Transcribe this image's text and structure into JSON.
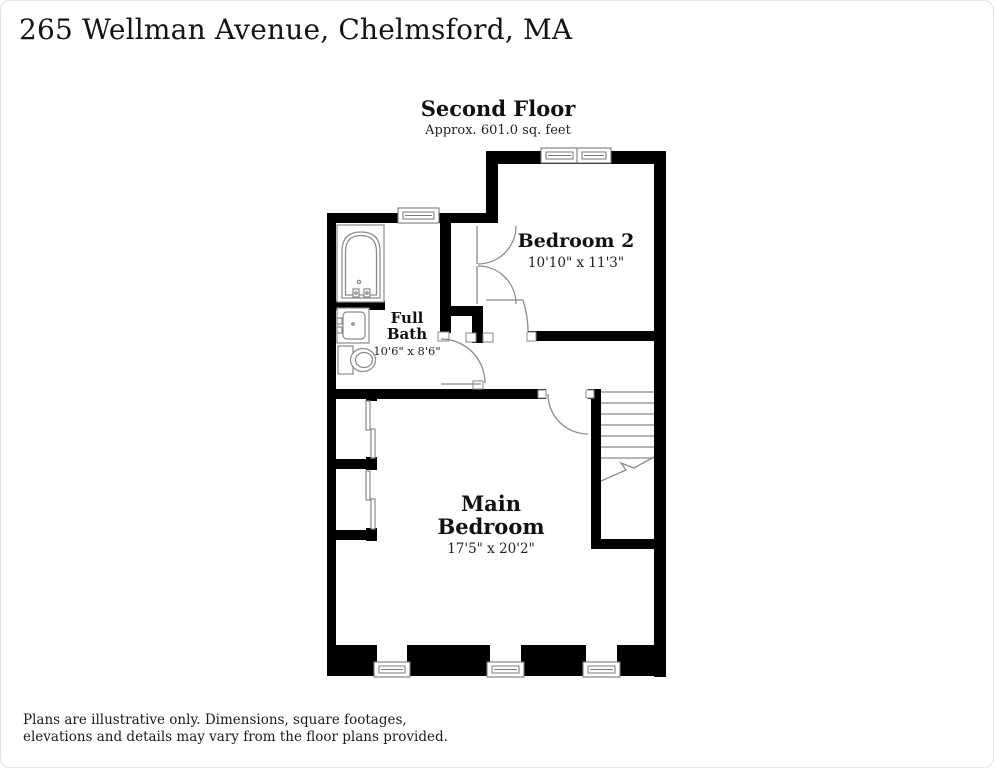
{
  "header": {
    "title": "265 Wellman Avenue, Chelmsford, MA"
  },
  "plan": {
    "heading": "Second Floor",
    "subheading": "Approx. 601.0 sq. feet"
  },
  "rooms": {
    "bedroom2": {
      "name": "Bedroom 2",
      "dims": "10'10\" x 11'3\""
    },
    "bath": {
      "line1": "Full",
      "line2": "Bath",
      "dims": "10'6\" x 8'6\""
    },
    "main": {
      "line1": "Main",
      "line2": "Bedroom",
      "dims": "17'5\" x 20'2\""
    }
  },
  "fixtures": [
    "bathtub-icon",
    "sink-icon",
    "toilet-icon",
    "staircase"
  ],
  "colors": {
    "wall": "#000000",
    "fixture_line": "#8a8a8a",
    "background": "#ffffff",
    "text": "#111111"
  },
  "footer": {
    "line1": "Plans are illustrative only. Dimensions, square footages,",
    "line2": "elevations and details may vary from the floor plans provided."
  }
}
